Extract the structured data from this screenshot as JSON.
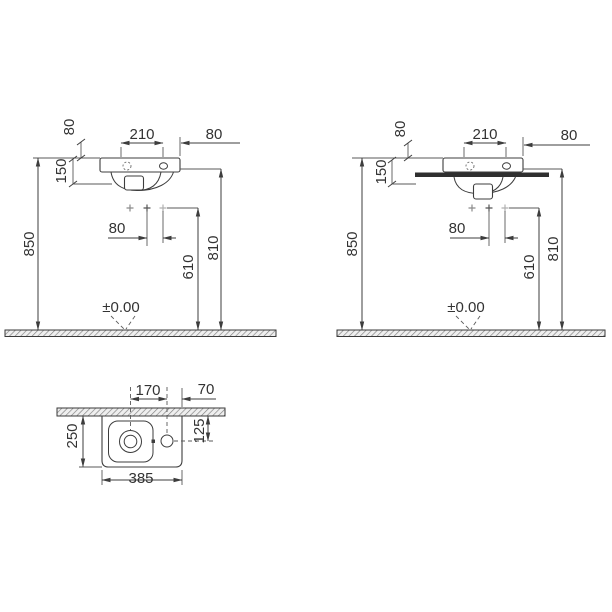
{
  "elevation_dims": {
    "upper_clearance": "80",
    "drain_to_tap_span": "210",
    "tap_to_side_edge": "80",
    "basin_front_height": "150",
    "hole_spacing": "80",
    "holes_to_floor_height": "610",
    "fixing_to_floor_height": "810",
    "rim_to_floor_height": "850",
    "floor_level": "±0.00"
  },
  "plan_dims": {
    "drain_to_tap": "170",
    "tap_to_right_edge": "70",
    "basin_depth": "250",
    "tap_setback": "125",
    "basin_width": "385"
  },
  "colors": {
    "line": "#3d3d3d",
    "text": "#333333",
    "countertop_fill": "#2f2f2f",
    "background": "#ffffff"
  }
}
